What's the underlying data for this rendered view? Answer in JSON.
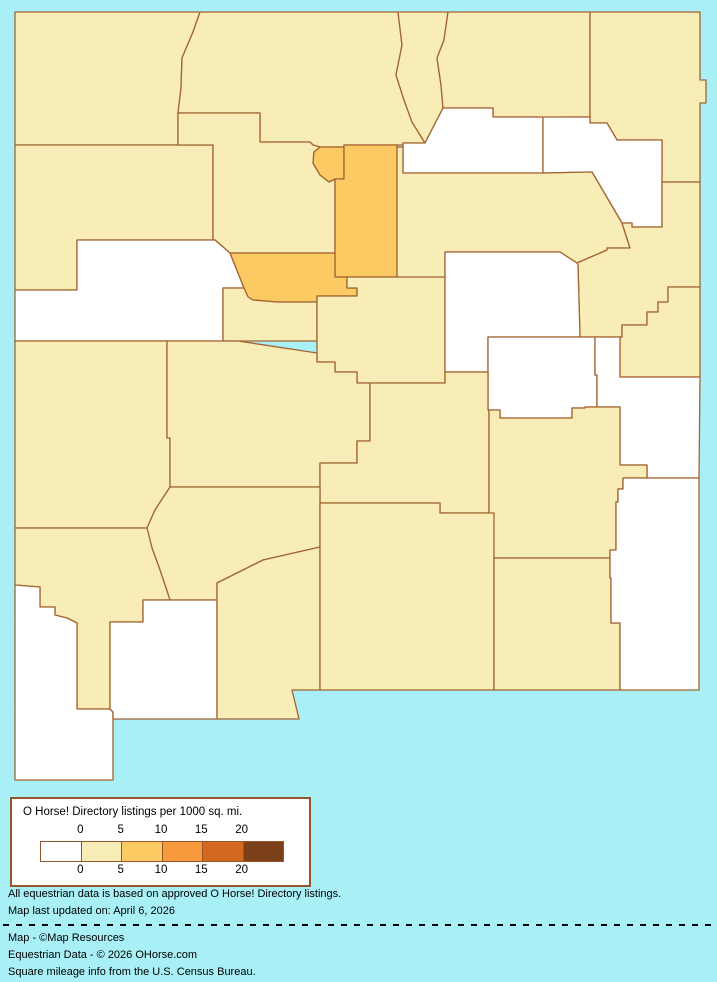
{
  "app": {
    "background_color": "#A8F0F6"
  },
  "map": {
    "border_color": "#A36431",
    "levels": {
      "zero": "#FFFFFF",
      "low": "#F8EDB7",
      "mid": "#FBCA63"
    }
  },
  "legend": {
    "title": "O Horse! Directory listings per 1000 sq. mi.",
    "tick_labels": [
      "0",
      "5",
      "10",
      "15",
      "20"
    ],
    "swatch_colors": [
      "#FFFFFF",
      "#F8EDB7",
      "#FBCA63",
      "#F79A3D",
      "#D2691E",
      "#7B3F1A"
    ],
    "background": "#FFFFFF",
    "border_color": "#96552A"
  },
  "footer": {
    "note_line1": "All equestrian data is based on approved O Horse! Directory listings.",
    "note_line2": "Map last updated on: April 6, 2026",
    "credit_line1": "Map - ©Map Resources",
    "credit_line2": "Equestrian Data - © 2026 OHorse.com",
    "credit_line3": "Square mileage info from the U.S. Census Bureau."
  }
}
